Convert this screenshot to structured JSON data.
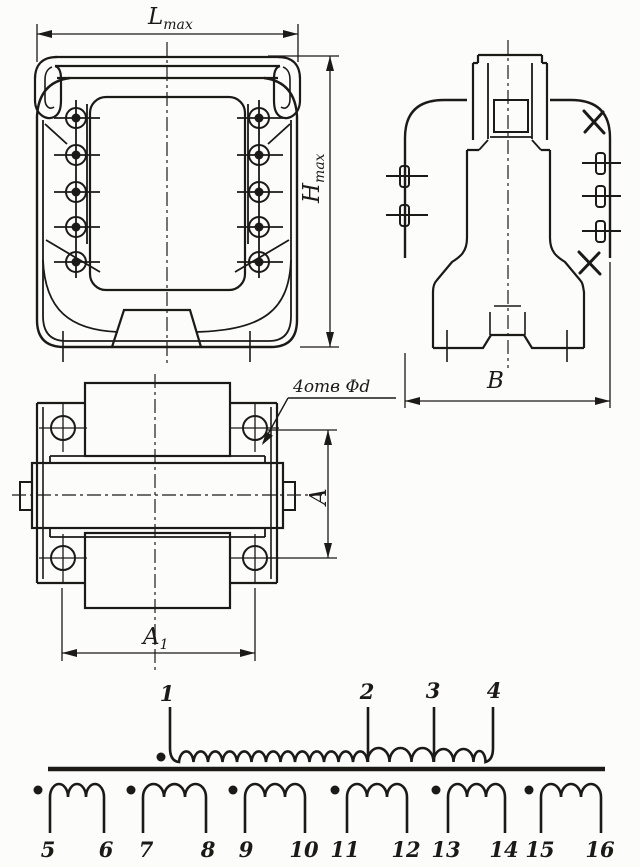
{
  "colors": {
    "ink": "#1c1a17",
    "paper": "#fcfcfa"
  },
  "dimensions": {
    "length_max": {
      "symbol": "L",
      "subscript": "max"
    },
    "height_max": {
      "symbol": "H",
      "subscript": "max"
    },
    "coil_width": {
      "symbol": "A"
    },
    "hole_spacing": {
      "symbol": "A",
      "subscript": "1"
    },
    "depth": {
      "symbol": "В"
    },
    "holes_note": "4отв Φd"
  },
  "views": {
    "front": {
      "terminal_rows_per_side": 5
    },
    "side": {
      "lugs_left": 2,
      "lugs_right": 3,
      "crossed_positions": 2
    },
    "top": {
      "mounting_holes": 4
    }
  },
  "schematic": {
    "primary_winding": {
      "terminals": [
        "1",
        "2",
        "3",
        "4"
      ],
      "polarity_dot": true,
      "segments": [
        {
          "from": "1",
          "to": "2",
          "turns_drawn": 13
        },
        {
          "from": "2",
          "to": "3",
          "turns_drawn": 3
        },
        {
          "from": "3",
          "to": "4",
          "turns_drawn": 3
        }
      ]
    },
    "secondary_windings": [
      {
        "terminals": [
          "5",
          "6"
        ],
        "turns_drawn": 3,
        "polarity_dot": true
      },
      {
        "terminals": [
          "7",
          "8"
        ],
        "turns_drawn": 3,
        "polarity_dot": true
      },
      {
        "terminals": [
          "9",
          "10"
        ],
        "turns_drawn": 3,
        "polarity_dot": true
      },
      {
        "terminals": [
          "11",
          "12"
        ],
        "turns_drawn": 3,
        "polarity_dot": true
      },
      {
        "terminals": [
          "13",
          "14"
        ],
        "turns_drawn": 3,
        "polarity_dot": true
      },
      {
        "terminals": [
          "15",
          "16"
        ],
        "turns_drawn": 3,
        "polarity_dot": true
      }
    ]
  }
}
